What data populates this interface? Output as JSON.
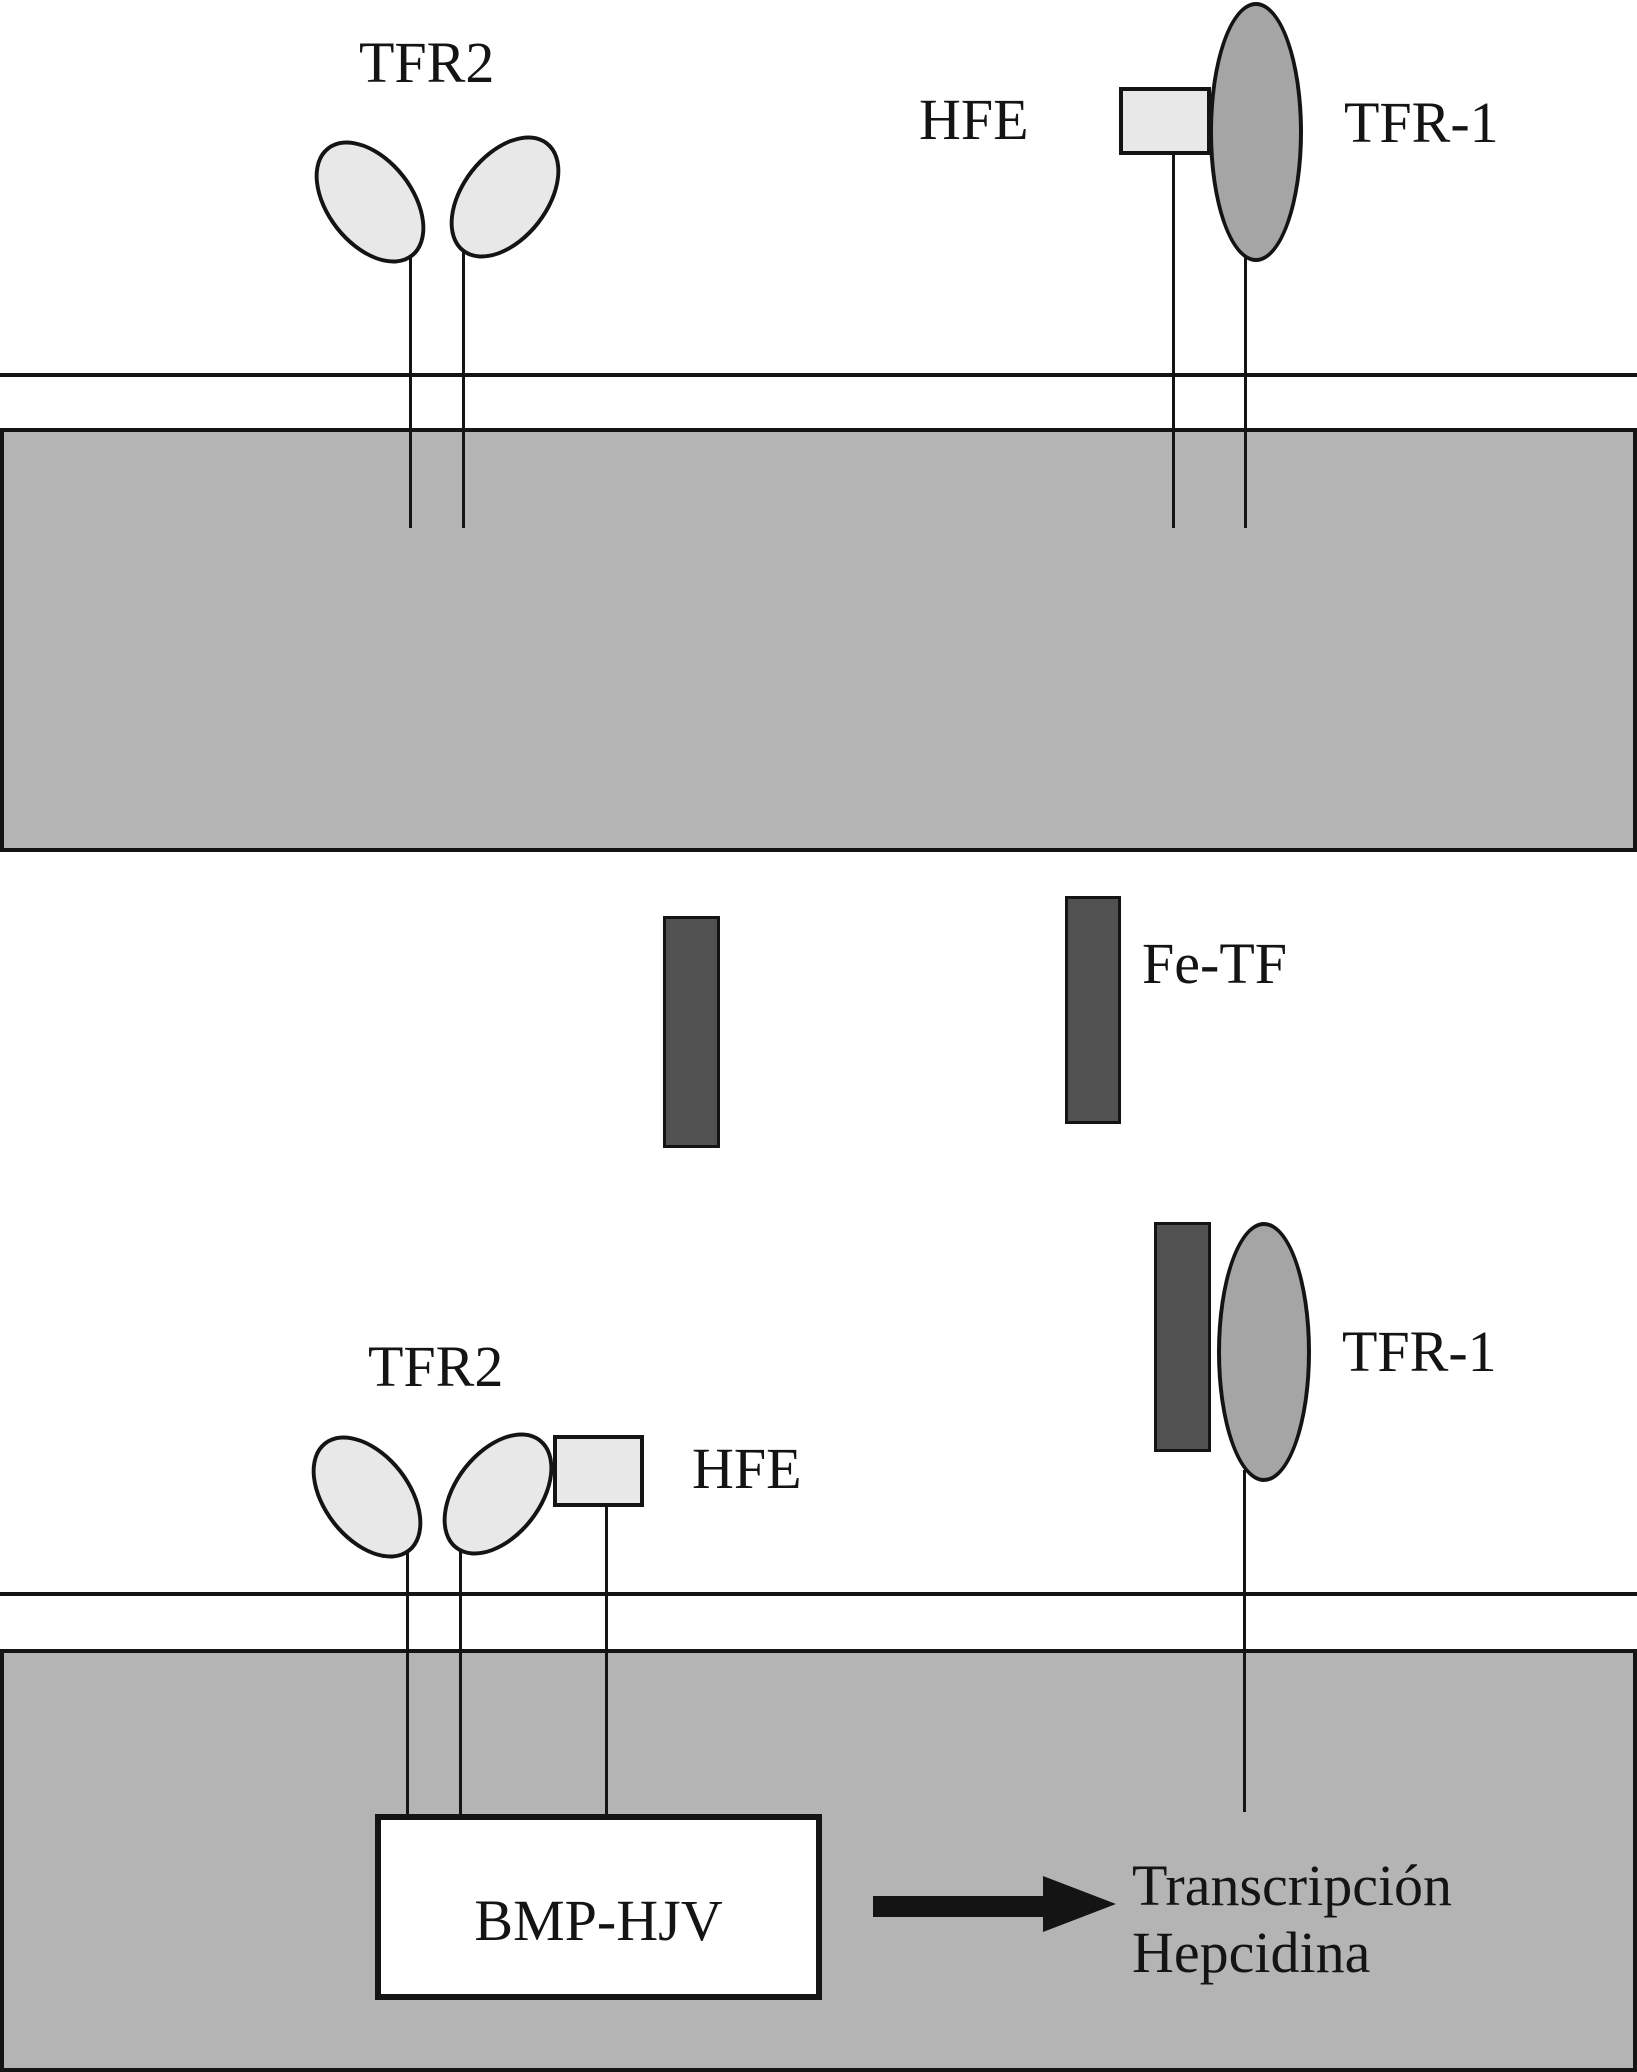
{
  "labels": {
    "tfr2_top": "TFR2",
    "hfe_top": "HFE",
    "tfr1_top": "TFR-1",
    "fe_tf": "Fe-TF",
    "tfr2_bottom": "TFR2",
    "hfe_bottom": "HFE",
    "tfr1_bottom": "TFR-1",
    "bmp_hjv": "BMP-HJV",
    "transcription_line1": "Transcripción",
    "transcription_line2": "Hepcidina"
  },
  "colors": {
    "background": "#ffffff",
    "membrane-band": "#b4b4b4",
    "light-receptor": "#e8e8e8",
    "medium-receptor": "#a5a5a5",
    "dark-ligand": "#515151",
    "outline": "#141414"
  }
}
